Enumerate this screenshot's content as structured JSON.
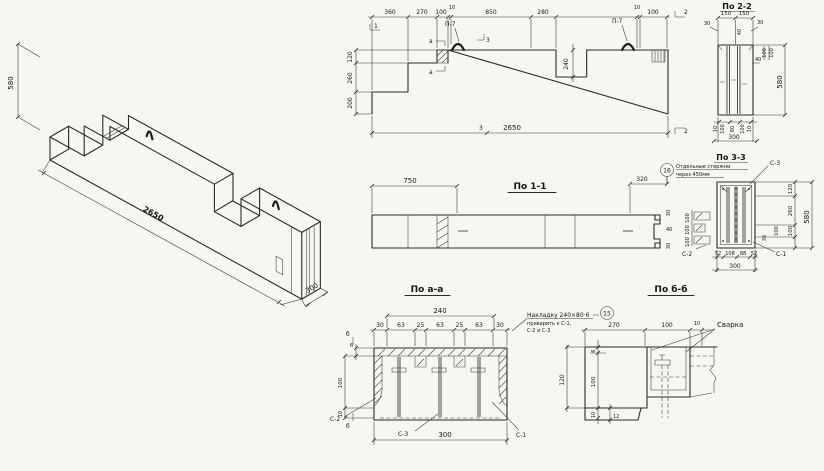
{
  "iso": {
    "d580": "580",
    "d2650": "2650",
    "d300": "300"
  },
  "elev": {
    "top": [
      "360",
      "270",
      "100",
      "10",
      "850",
      "280",
      "10",
      "100"
    ],
    "left": [
      "120",
      "260",
      "200"
    ],
    "notch": "240",
    "bottom": "2650",
    "p7a": "П-7",
    "p7b": "П-7",
    "m1": "1",
    "m2t": "2",
    "m2b": "2",
    "m3t": "3",
    "m3b": "3",
    "mat": "а",
    "mab": "а"
  },
  "s11": {
    "title": "По 1-1",
    "d750": "750",
    "d320": "320",
    "r30t": "30",
    "r40": "40",
    "r30b": "30"
  },
  "note16": {
    "num": "16",
    "l1": "Отдельные стержни",
    "l2": "через 450мм"
  },
  "s22": {
    "title": "По 2-2",
    "t150a": "150",
    "t150b": "150",
    "s30l": "30",
    "s30r": "30",
    "s40": "40",
    "r100a": "100",
    "r100b": "100",
    "r40": "40",
    "r580": "580",
    "b10a": "10",
    "b100a": "100",
    "b80": "80",
    "b100b": "100",
    "b10b": "10",
    "b300": "300"
  },
  "s33": {
    "title": "По 3-3",
    "c3": "С-3",
    "c2": "С-2",
    "c1": "С-1",
    "k100a": "100",
    "k100b": "100",
    "k100c": "100",
    "r120": "120",
    "r260": "260",
    "r100": "100",
    "r36": "36",
    "rr100": "100",
    "r580": "580",
    "b52a": "52",
    "b108": "108",
    "b88": "88",
    "b52b": "52",
    "b300": "300"
  },
  "saa": {
    "title": "По а-а",
    "d240": "240",
    "row": [
      "30",
      "63",
      "25",
      "63",
      "25",
      "63",
      "30"
    ],
    "l6": "6",
    "l100": "100",
    "l10": "10",
    "b300": "300",
    "c2": "С-2",
    "c3": "С-3",
    "c1": "С-1",
    "mbt": "б",
    "mbb": "б"
  },
  "note15": {
    "num": "15",
    "l1": "Накладку 240×80·6",
    "l2": "приварить к С-1,",
    "l3": "С-2 и С-3"
  },
  "sbb": {
    "title": "По б-б",
    "d270": "270",
    "d100": "100",
    "d10": "10",
    "svarka": "Сварка",
    "l120": "120",
    "l6": "6",
    "l100": "100",
    "l10": "10",
    "b12": "12"
  }
}
